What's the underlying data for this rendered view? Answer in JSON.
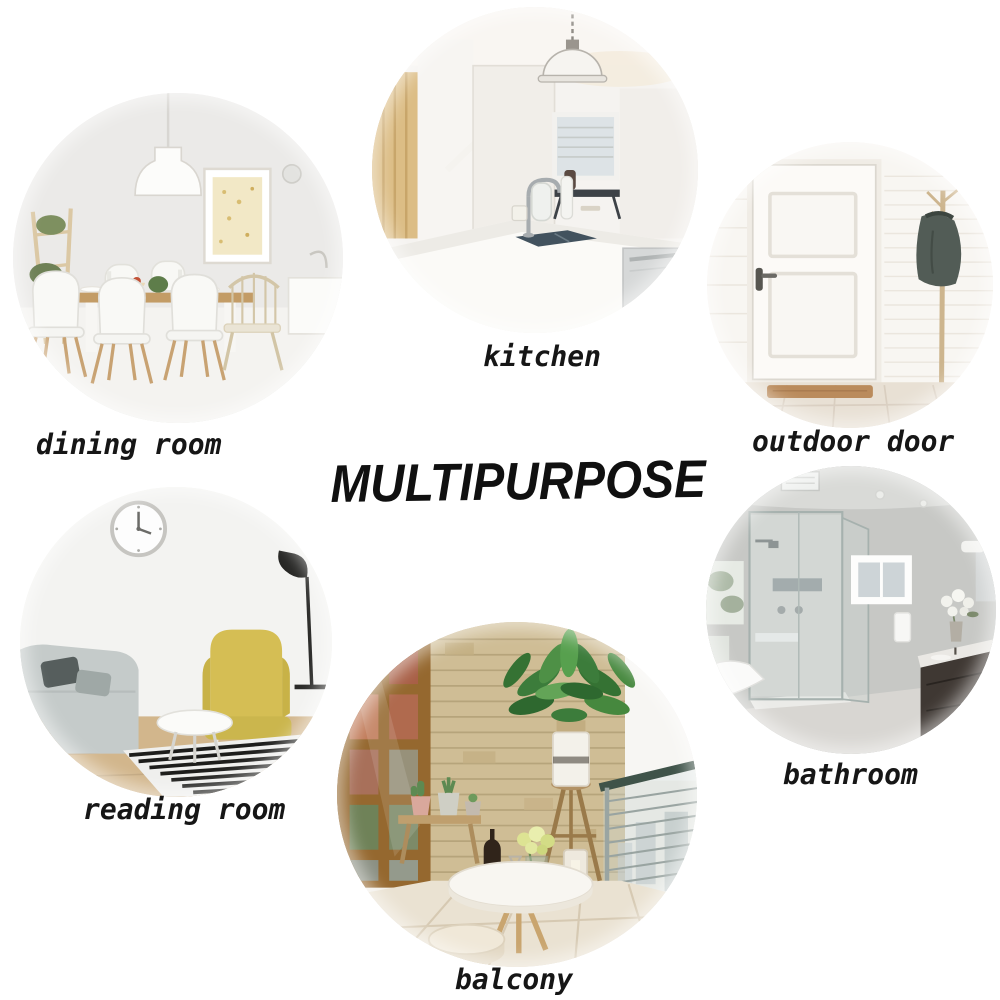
{
  "title": "MULTIPURPOSE",
  "rooms": [
    {
      "id": "dining-room",
      "label": "dining room"
    },
    {
      "id": "kitchen",
      "label": "kitchen"
    },
    {
      "id": "outdoor-door",
      "label": "outdoor door"
    },
    {
      "id": "reading-room",
      "label": "reading room"
    },
    {
      "id": "bathroom",
      "label": "bathroom"
    },
    {
      "id": "balcony",
      "label": "balcony"
    }
  ],
  "style": {
    "background": "#ffffff",
    "label_color": "#161616",
    "title_color": "#101010"
  }
}
